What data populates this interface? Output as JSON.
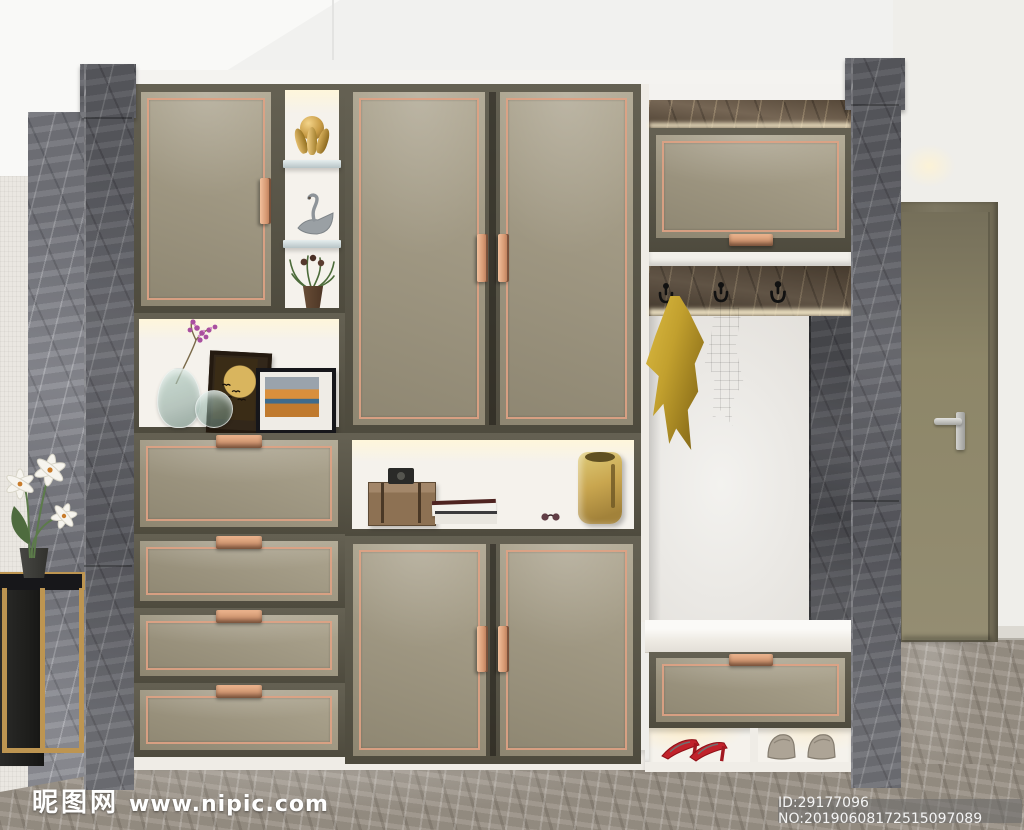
{
  "watermark": {
    "logo_text": "昵图网",
    "site_url": "www.nipic.com",
    "id_label": "ID:29177096 NO:20190608172515097089"
  },
  "scene": {
    "type": "3d-interior-render",
    "objects": [
      "gray-marble-pillars",
      "khaki-cabinet-doors-rose-gold-trim",
      "open-display-niche-with-vases-and-art-frames",
      "gold-hands-sphere-ornament",
      "swan-figurine",
      "potted-plant",
      "four-drawer-stack",
      "middle-niche-with-wood-box-books-sunglasses-gold-bag",
      "coat-hooks-with-yellow-and-gray-towels",
      "mirror-recess",
      "bench-with-drawer",
      "shoe-niche-red-heels-gray-loafers",
      "gold-side-table-with-white-lilies",
      "interior-door",
      "marble-floor"
    ]
  },
  "colors": {
    "cabinet_panel": "#a59c84",
    "cabinet_frame": "#5b5748",
    "trim_rose_gold": "#dfa284",
    "carcass_white": "#efece6",
    "niche_white": "#f5f2ec",
    "marble_gray": "#63646a",
    "marble_brown": "#6a5946",
    "floor_marble": "#9a9287",
    "ceiling_white": "#f1f1ef",
    "wall_white": "#efeeea",
    "towel_yellow": "#c2a02e",
    "towel_gray": "#a6a6a1",
    "bag_gold": "#c9a64f",
    "heels_red": "#c1222b",
    "loafers_gray": "#ada496",
    "interior_door": "#8d8668",
    "table_gold": "#bd9551",
    "glass_teal": "#9fb9af"
  }
}
